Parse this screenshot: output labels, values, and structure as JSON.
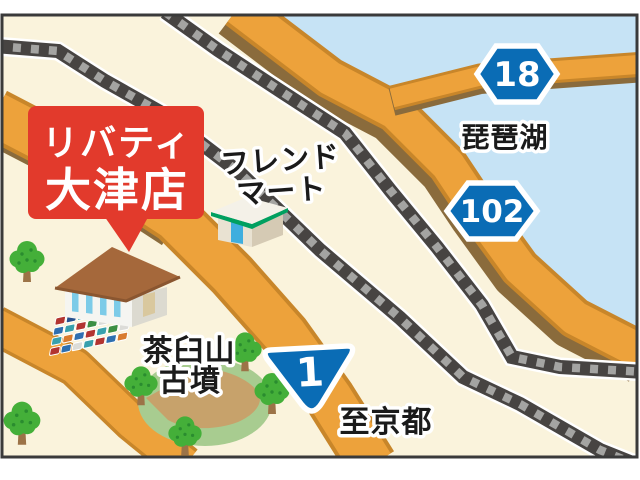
{
  "callout": {
    "line1": "リバティ",
    "line2": "大津店"
  },
  "labels": {
    "friend_mart_line1": "フレンド",
    "friend_mart_line2": "マート",
    "lake": "琵琶湖",
    "kofun_line1": "茶臼山",
    "kofun_line2": "古墳",
    "to_kyoto": "至京都"
  },
  "route_badges": {
    "prefectural_18": "18",
    "prefectural_102": "102",
    "national_1": "1"
  },
  "parking": {
    "car_colors": [
      "#b23430",
      "#27508e",
      "#38a0ad",
      "#dcdcd8",
      "#b23430",
      "#2e6fb0",
      "#d97b2e",
      "#2e6fb0",
      "#38a0ad",
      "#b23430",
      "#3c8f44",
      "#dcdcd8",
      "#b23430",
      "#2e6fb0",
      "#38a0ad",
      "#d97b2e",
      "#2e6fb0",
      "#b23430",
      "#38a0ad",
      "#3c8f44",
      "#dcdcd8",
      "#b23430",
      "#2e6fb0",
      "#dcdcd8",
      "#38a0ad",
      "#b23430",
      "#2e6fb0",
      "#d97b2e"
    ]
  },
  "colors": {
    "land": "#faf3dc",
    "lake": "#c6e3f5",
    "road": "#eda23b",
    "road_edge": "#c8862a",
    "road_shadow": "#8a6b3c",
    "rail_dark": "#474442",
    "rail_tie": "#a4a4a2",
    "badge_blue": "#0a6cb5",
    "callout_red": "#e23a2c",
    "tree_green": "#44af39",
    "mound_green": "#a8cc90",
    "mound_path_tan": "#c7a26b",
    "roof_brown": "#a5683b",
    "frame": "#3a3a3a"
  }
}
